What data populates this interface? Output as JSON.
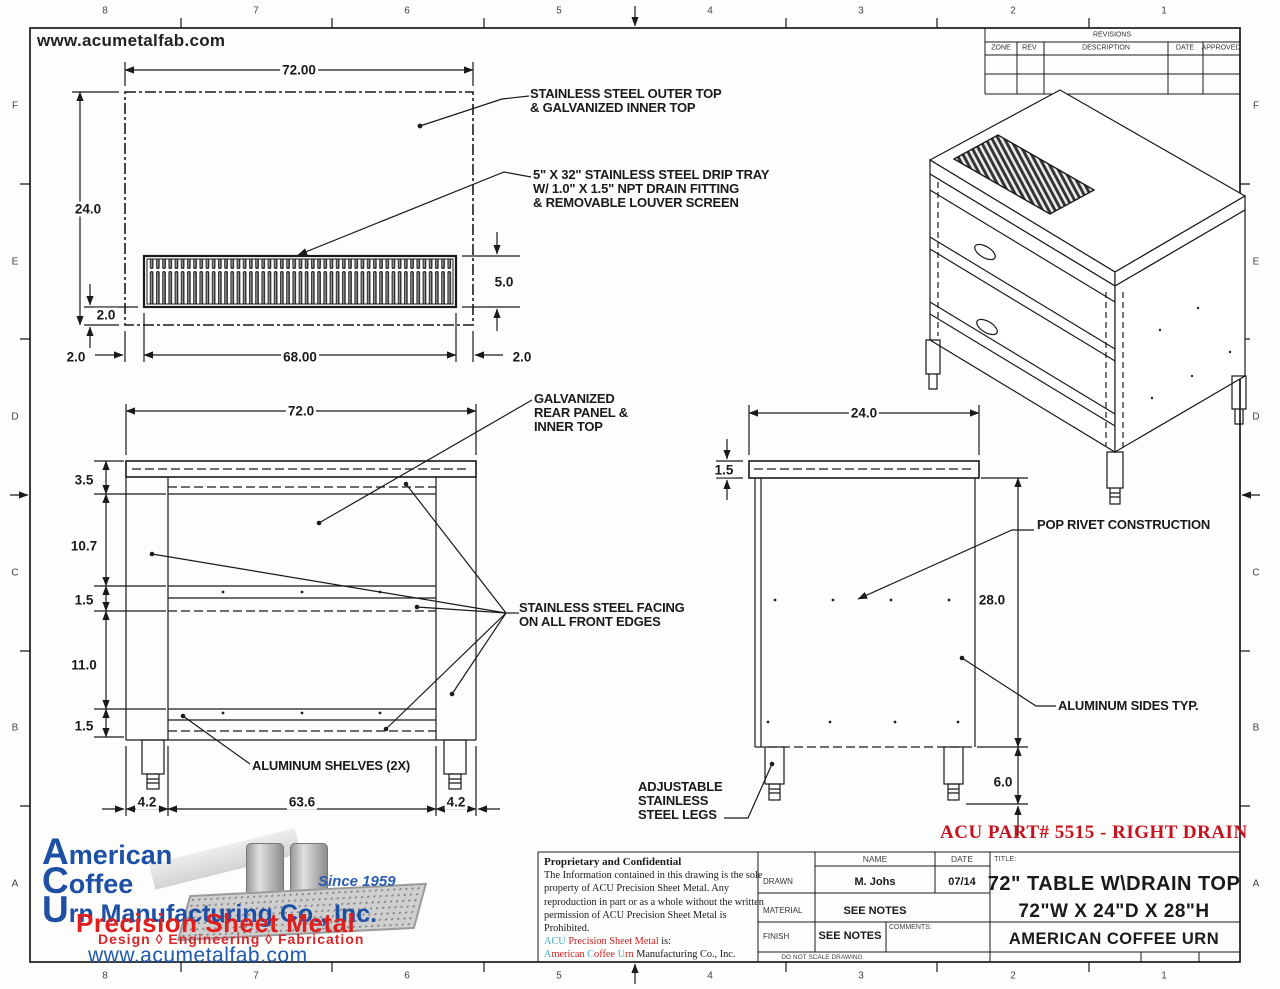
{
  "header_url": "www.acumetalfab.com",
  "part_note": "ACU PART# 5515 - RIGHT DRAIN",
  "border": {
    "cols": [
      "8",
      "7",
      "6",
      "5",
      "4",
      "3",
      "2",
      "1"
    ],
    "rows": [
      "F",
      "E",
      "D",
      "C",
      "B",
      "A"
    ]
  },
  "revisions": {
    "title": "REVISIONS",
    "zone": "ZONE",
    "rev": "REV.",
    "desc": "DESCRIPTION",
    "date": "DATE",
    "approved": "APPROVED"
  },
  "notes": {
    "outer_top": [
      "STAINLESS STEEL OUTER TOP",
      "& GALVANIZED INNER TOP"
    ],
    "drip_tray": [
      "5\" X 32\" STAINLESS STEEL DRIP TRAY",
      "W/ 1.0\" X 1.5\" NPT DRAIN FITTING",
      "& REMOVABLE LOUVER SCREEN"
    ],
    "rear_panel": [
      "GALVANIZED",
      "REAR PANEL &",
      "INNER TOP"
    ],
    "ss_facing": [
      "STAINLESS STEEL FACING",
      "ON ALL FRONT EDGES"
    ],
    "shelves": "ALUMINUM SHELVES (2X)",
    "pop_rivet": "POP RIVET CONSTRUCTION",
    "alum_sides": "ALUMINUM SIDES TYP.",
    "legs": [
      "ADJUSTABLE",
      "STAINLESS",
      "STEEL LEGS"
    ]
  },
  "dims": {
    "top": {
      "width": "72.00",
      "depth": "24.0",
      "tray_offset": "2.0",
      "tray_height": "5.0",
      "left_margin": "2.0",
      "tray_length": "68.00",
      "right_margin": "2.0"
    },
    "front": {
      "width": "72.0",
      "top_band": "3.5",
      "upper": "10.7",
      "shelf1": "1.5",
      "lower": "11.0",
      "shelf2": "1.5",
      "left_leg": "4.2",
      "span": "63.6",
      "right_leg": "4.2"
    },
    "side": {
      "depth": "24.0",
      "top_band": "1.5",
      "height": "28.0",
      "leg": "6.0"
    }
  },
  "title_block": {
    "name_header": "NAME",
    "date_header": "DATE",
    "drawn_label": "DRAWN",
    "drawn_name": "M. Johs",
    "drawn_date": "07/14",
    "material_label": "MATERIAL",
    "material_value": "SEE NOTES",
    "finish_label": "FINISH",
    "finish_value": "SEE NOTES",
    "comments_label": "COMMENTS:",
    "do_not_scale": "DO NOT SCALE DRAWING",
    "title_label": "TITLE:",
    "title_line1": "72\" TABLE  W\\DRAIN TOP",
    "title_line2": "72\"W X 24\"D X 28\"H",
    "title_line3": "AMERICAN COFFEE URN"
  },
  "proprietary": {
    "heading": "Proprietary and Confidential",
    "lines": [
      "The Information contained in this drawing is the sole",
      "property of ACU Precision Sheet Metal. Any",
      "reproduction in part or as a whole without the written",
      "permission of ACU Precision Sheet Metal is",
      "Prohibited."
    ],
    "brand_acu": "ACU",
    "brand_mid": " Precision Sheet Metal",
    "brand_suffix": " is:",
    "co_a": "A",
    "co_merican": "merican ",
    "co_c": "C",
    "co_offee": "offee ",
    "co_u": "U",
    "co_rn": "rn ",
    "co_rest": "Manufacturing Co., Inc."
  },
  "logo": {
    "word1_initial": "A",
    "word1_rest": "merican",
    "word2_initial": "C",
    "word2_rest": "offee",
    "word3_initial": "U",
    "word3_rest": "rn Manufacturing Co., Inc.",
    "since": "Since 1959",
    "tagline": "Precision Sheet Metal",
    "services": "Design  ◊  Engineering  ◊  Fabrication",
    "url": "www.acumetalfab.com"
  },
  "colors": {
    "part_note_red": "#c8101e",
    "logo_blue": "#1d4fa5",
    "logo_red": "#e01e1e",
    "brand_teal": "#3fb0c6",
    "line_black": "#1a1a1a"
  }
}
